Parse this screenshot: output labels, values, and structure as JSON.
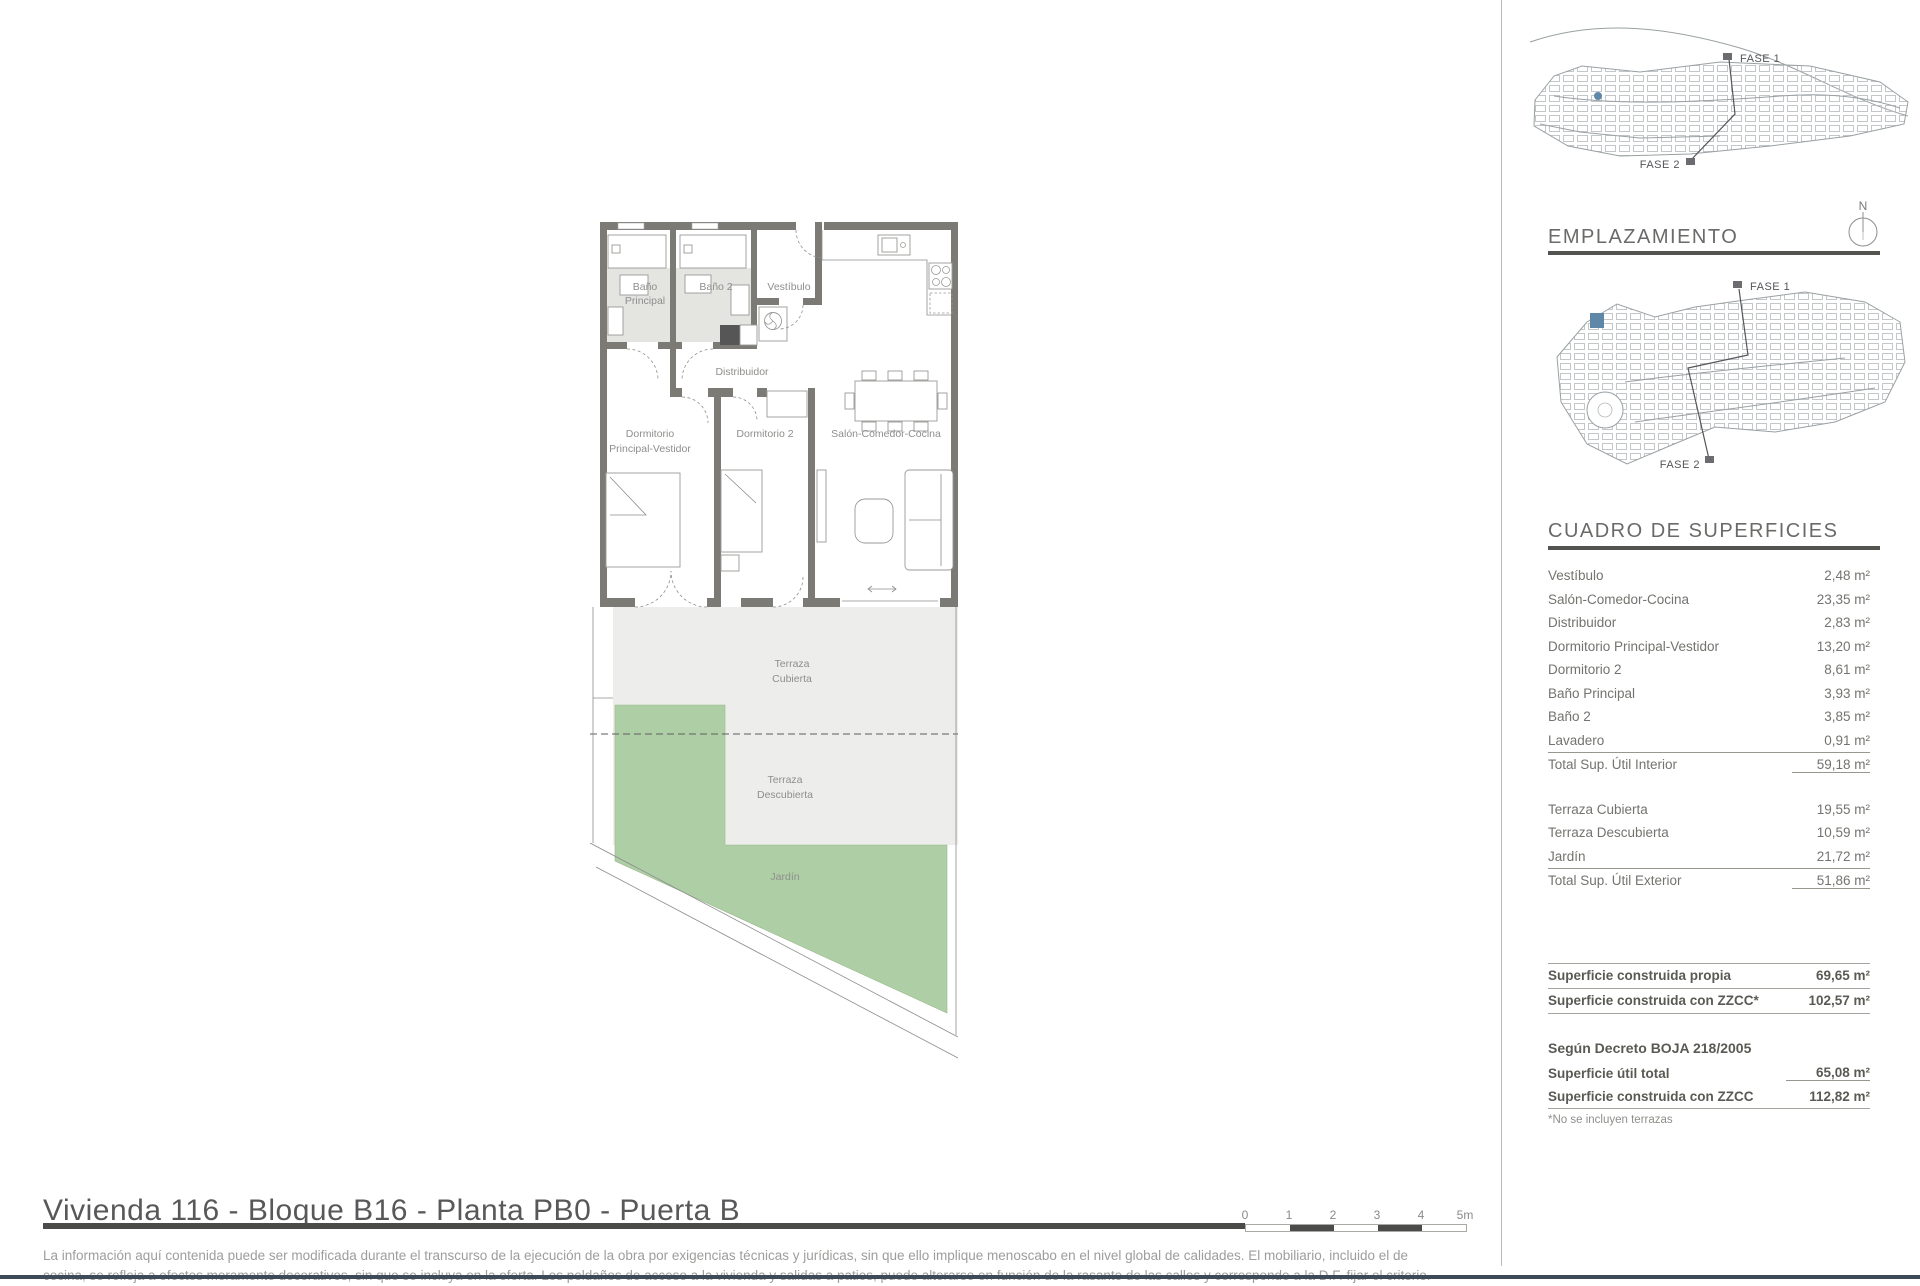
{
  "page": {
    "title": "Vivienda 116 - Bloque B16 - Planta PB0 - Puerta B",
    "disclaimer_line1": "La información aquí contenida puede ser modificada durante el transcurso de la ejecución de la obra por exigencias técnicas y jurídicas, sin que ello implique menoscabo en el nivel global de calidades. El mobiliario, incluido el de",
    "disclaimer_line2": "cocina, se refleja a efectos meramente decorativos, sin que se incluya en la oferta. Los peldaños de acceso a la vivienda y salidas a patios, puede alterarse en función de la rasante de las calles y corresponde a la D.F. fijar el criterio."
  },
  "scale_bar": {
    "ticks": [
      "0",
      "1",
      "2",
      "3",
      "4",
      "5m"
    ]
  },
  "plan": {
    "labels": {
      "bano_principal_l1": "Baño",
      "bano_principal_l2": "Principal",
      "bano2": "Baño 2",
      "vestibulo": "Vestíbulo",
      "distribuidor": "Distribuidor",
      "dormitorio_ppal_l1": "Dormitorio",
      "dormitorio_ppal_l2": "Principal-Vestidor",
      "dormitorio2": "Dormitorio 2",
      "salon": "Salón-Comedor-Cocina",
      "terraza_cubierta_l1": "Terraza",
      "terraza_cubierta_l2": "Cubierta",
      "terraza_descubierta_l1": "Terraza",
      "terraza_descubierta_l2": "Descubierta",
      "jardin": "Jardín"
    },
    "colors": {
      "wall": "#7b7a75",
      "terrace": "#ededeb",
      "garden": "#aecfa5",
      "bath_floor": "#e4e4e1",
      "shaft": "#565656"
    }
  },
  "sidebar": {
    "emplazamiento_title": "EMPLAZAMIENTO",
    "compass_label": "N",
    "fase1": "FASE 1",
    "fase2": "FASE 2",
    "highlight_color": "#5f87a8",
    "superficies": {
      "title": "CUADRO DE SUPERFICIES",
      "interior_rows": [
        {
          "label": "Vestíbulo",
          "value": "2,48 m²"
        },
        {
          "label": "Salón-Comedor-Cocina",
          "value": "23,35 m²"
        },
        {
          "label": "Distribuidor",
          "value": "2,83 m²"
        },
        {
          "label": "Dormitorio Principal-Vestidor",
          "value": "13,20 m²"
        },
        {
          "label": "Dormitorio 2",
          "value": "8,61 m²"
        },
        {
          "label": "Baño Principal",
          "value": "3,93 m²"
        },
        {
          "label": "Baño 2",
          "value": "3,85 m²"
        },
        {
          "label": "Lavadero",
          "value": "0,91 m²"
        }
      ],
      "interior_total": {
        "label": "Total Sup. Útil Interior",
        "value": "59,18 m²"
      },
      "exterior_rows": [
        {
          "label": "Terraza Cubierta",
          "value": "19,55 m²"
        },
        {
          "label": "Terraza Descubierta",
          "value": "10,59 m²"
        },
        {
          "label": "Jardín",
          "value": "21,72 m²"
        }
      ],
      "exterior_total": {
        "label": "Total Sup. Útil Exterior",
        "value": "51,86 m²"
      },
      "construida_rows": [
        {
          "label": "Superficie construida propia",
          "value": "69,65 m²"
        },
        {
          "label": "Superficie construida con ZZCC*",
          "value": "102,57 m²"
        }
      ],
      "decreto_heading": "Según Decreto BOJA 218/2005",
      "decreto_rows": [
        {
          "label": "Superficie útil total",
          "value": "65,08 m²"
        },
        {
          "label": "Superficie construida con ZZCC",
          "value": "112,82 m²"
        }
      ],
      "footnote": "*No se incluyen terrazas"
    }
  }
}
